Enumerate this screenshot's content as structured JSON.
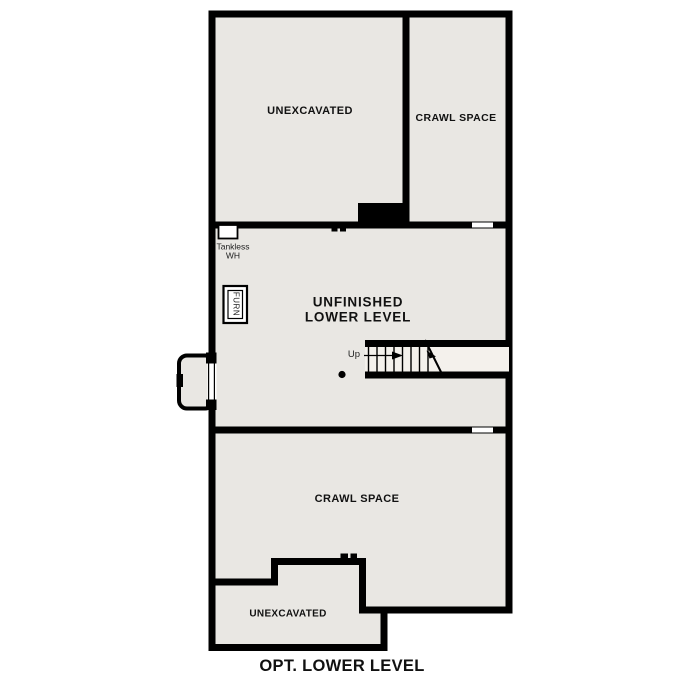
{
  "title": "OPT. LOWER LEVEL",
  "rooms": {
    "unexcavated_top": "UNEXCAVATED",
    "crawl_space_top": "CRAWL SPACE",
    "unfinished_line1": "UNFINISHED",
    "unfinished_line2": "LOWER LEVEL",
    "crawl_space_bottom": "CRAWL SPACE",
    "unexcavated_bottom": "UNEXCAVATED"
  },
  "equipment": {
    "tankless_line1": "Tankless",
    "tankless_line2": "WH",
    "furnace_label": "FURN"
  },
  "stairs": {
    "up_label": "Up"
  },
  "colors": {
    "background": "#ffffff",
    "floor": "#e9e7e3",
    "wall": "#000000",
    "stair_treads": "#f4f1ec"
  }
}
